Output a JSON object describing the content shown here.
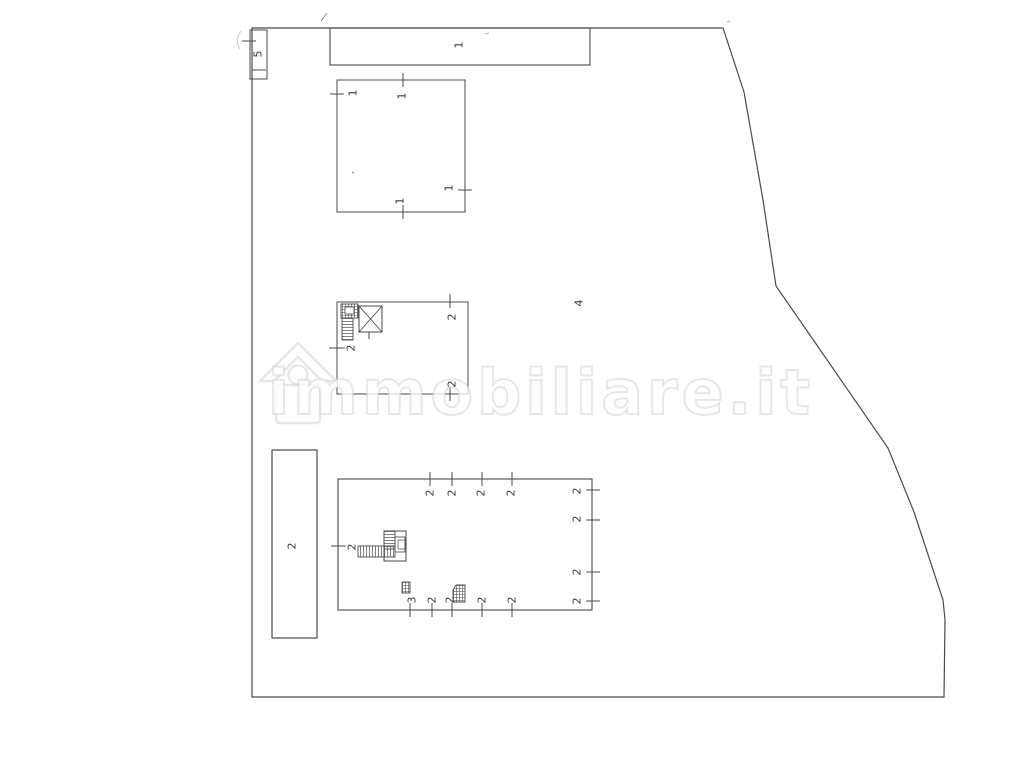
{
  "watermark": {
    "text": "immobiliare.it",
    "icon": "house-icon",
    "color": "#d4d4d4"
  },
  "plan": {
    "line_color": "#4a4a4a",
    "label_color": "#3d3d3d",
    "labels": [
      {
        "text": "5"
      },
      {
        "text": "1"
      },
      {
        "text": "1"
      },
      {
        "text": "1"
      },
      {
        "text": "1"
      },
      {
        "text": "1"
      },
      {
        "text": "2"
      },
      {
        "text": "2"
      },
      {
        "text": "2"
      },
      {
        "text": "4"
      },
      {
        "text": "2"
      },
      {
        "text": "2"
      },
      {
        "text": "2"
      },
      {
        "text": "2"
      },
      {
        "text": "2"
      },
      {
        "text": "2"
      },
      {
        "text": "2"
      },
      {
        "text": "2"
      },
      {
        "text": "2"
      },
      {
        "text": "2"
      },
      {
        "text": "3"
      },
      {
        "text": "2"
      },
      {
        "text": "2"
      },
      {
        "text": "2"
      },
      {
        "text": "2"
      }
    ]
  }
}
